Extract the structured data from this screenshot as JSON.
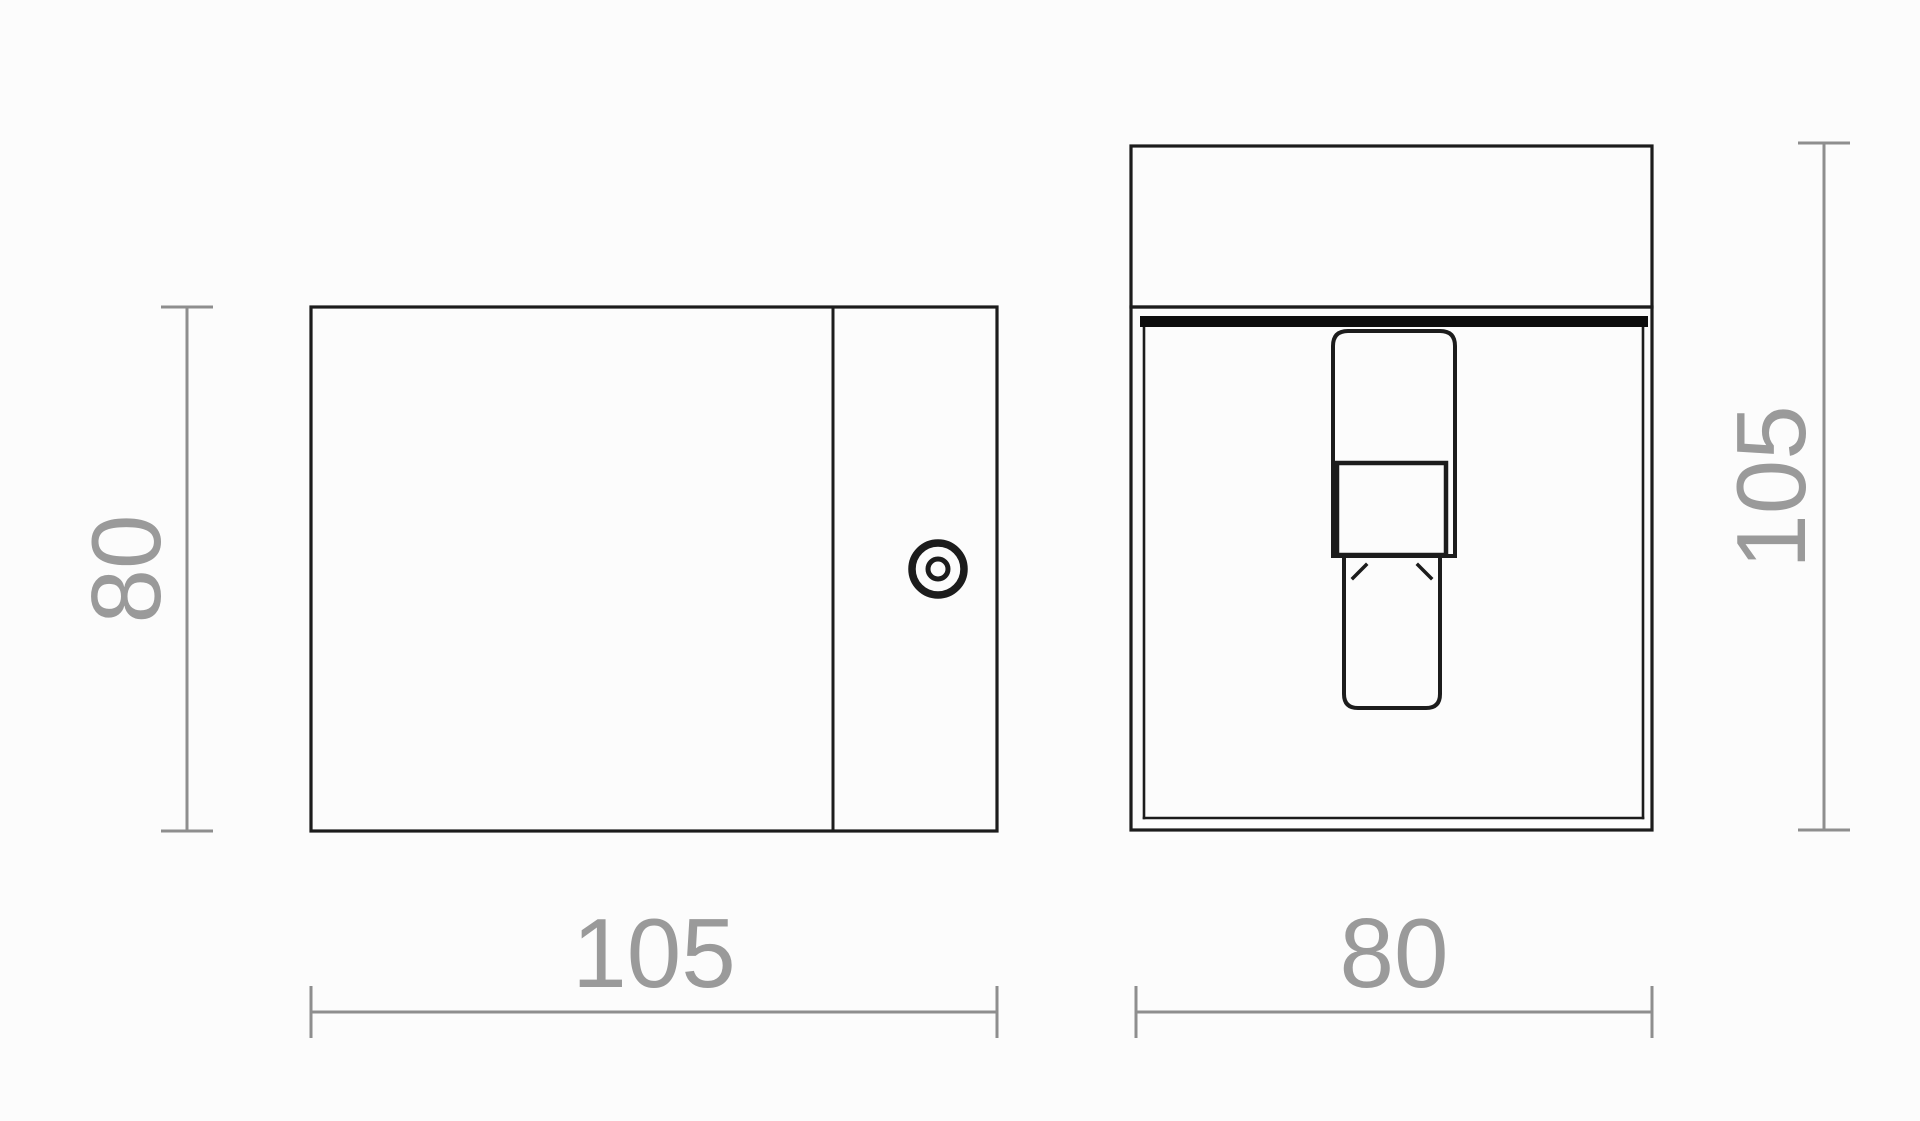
{
  "drawing": {
    "description": "Technical dimension drawing, two orthographic views of a cube wall lamp",
    "colors": {
      "background": "#fcfcfc",
      "line": "#1c1c1c",
      "slot_fill": "#0d0d0d",
      "dim_line": "#8e8e8e",
      "dim_text": "#9a9a9a"
    },
    "dimensions": {
      "side_height": "80",
      "side_width": "105",
      "front_height": "105",
      "front_width": "80"
    }
  }
}
